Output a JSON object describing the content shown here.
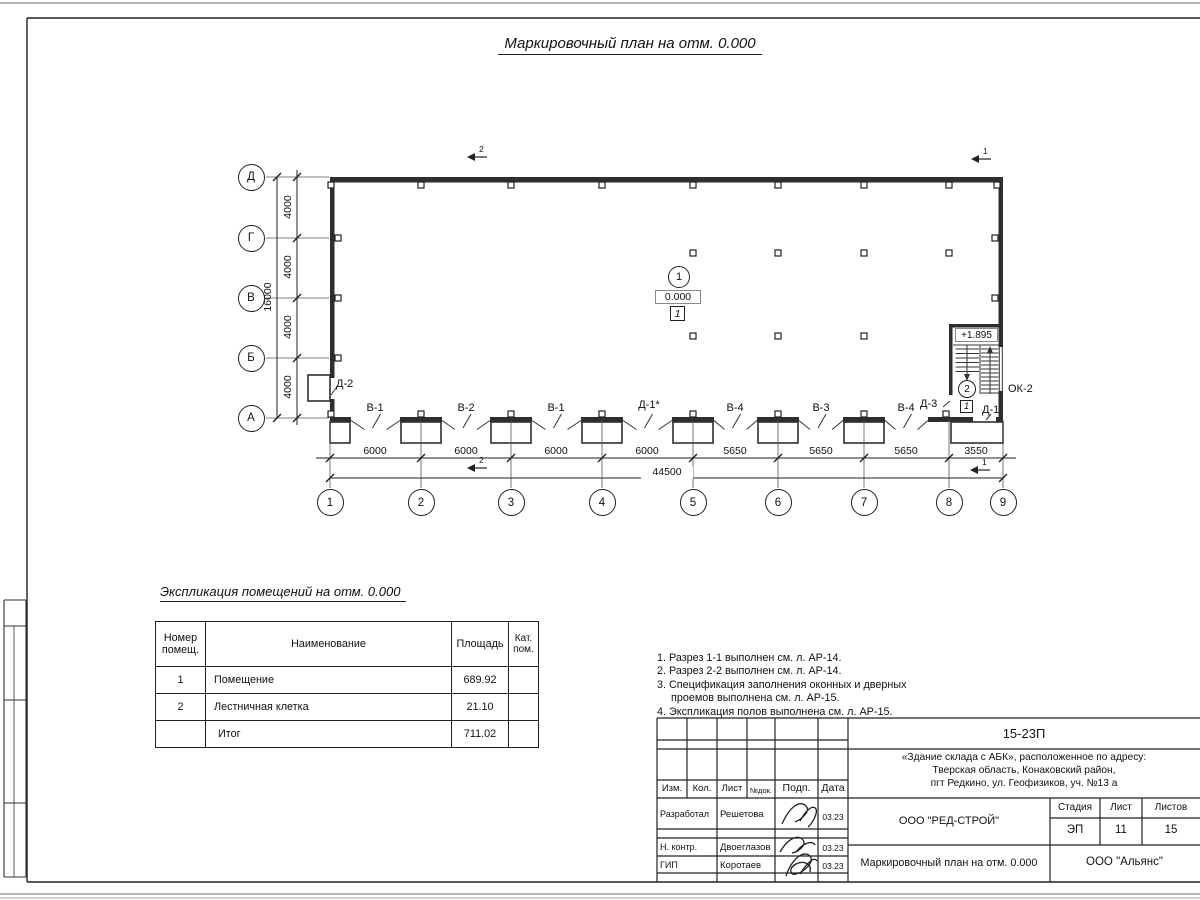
{
  "title": "Маркировочный план на отм. 0.000",
  "plan": {
    "row_axes": [
      "Д",
      "Г",
      "В",
      "Б",
      "А"
    ],
    "col_axes": [
      "1",
      "2",
      "3",
      "4",
      "5",
      "6",
      "7",
      "8",
      "9"
    ],
    "v_dims": [
      "4000",
      "4000",
      "4000",
      "4000"
    ],
    "v_total": "16000",
    "h_dims": [
      "6000",
      "6000",
      "6000",
      "6000",
      "5650",
      "5650",
      "5650",
      "3550"
    ],
    "h_total": "44500",
    "bay_labels": [
      "В-1",
      "В-2",
      "В-1",
      "Д-1*",
      "В-4",
      "В-3",
      "В-4"
    ],
    "door_d2": "Д-2",
    "room1": {
      "circle": "1",
      "level": "0.000",
      "square": "1"
    },
    "stair": {
      "level": "+1.895",
      "room_circle": "2",
      "room_square": "1",
      "door_left": "Д-3",
      "door_bottom": "Д-1",
      "window": "ОК-2"
    },
    "sections": {
      "top_left": "2",
      "top_right": "1",
      "bottom_left": "2",
      "bottom_right": "1"
    }
  },
  "explication": {
    "title": "Экспликация помещений на отм. 0.000",
    "headers": {
      "num": "Номер помещ.",
      "name": "Наименование",
      "area": "Площадь",
      "cat": "Кат. пом."
    },
    "rows": [
      {
        "num": "1",
        "name": "Помещение",
        "area": "689.92",
        "cat": ""
      },
      {
        "num": "2",
        "name": "Лестничная клетка",
        "area": "21.10",
        "cat": ""
      },
      {
        "num": "",
        "name": "Итог",
        "area": "711.02",
        "cat": ""
      }
    ]
  },
  "notes": [
    "1. Разрез 1-1 выполнен см. л. АР-14.",
    "2. Разрез 2-2 выполнен см. л. АР-14.",
    "3. Спецификация заполнения оконных и дверных",
    "проемов выполнена см. л. АР-15.",
    "4. Экспликация полов выполнена см. л. АР-15."
  ],
  "stamp": {
    "doc_number": "15-23П",
    "project_line1": "«Здание склада с АБК», расположенное по адресу:",
    "project_line2": "Тверская область, Конаковский район,",
    "project_line3": "пгт Редкино, ул. Геофизиков, уч. №13 а",
    "org": "ООО \"РЕД-СТРОЙ\"",
    "sheet_title": "Маркировочный план на отм. 0.000",
    "company": "ООО \"Альянс\"",
    "cols": {
      "izm": "Изм.",
      "kol": "Кол.",
      "list": "Лист",
      "ndok": "№док.",
      "podp": "Подп.",
      "data": "Дата"
    },
    "stage_label": "Стадия",
    "sheet_label": "Лист",
    "sheets_label": "Листов",
    "stage": "ЭП",
    "sheet_num": "11",
    "sheets_total": "15",
    "roles": [
      {
        "role": "Разработал",
        "name": "Решетова",
        "date": "03.23"
      },
      {
        "role": "Н. контр.",
        "name": "Двоеглазов",
        "date": "03.23"
      },
      {
        "role": "ГИП",
        "name": "Коротаев",
        "date": "03.23"
      }
    ]
  }
}
